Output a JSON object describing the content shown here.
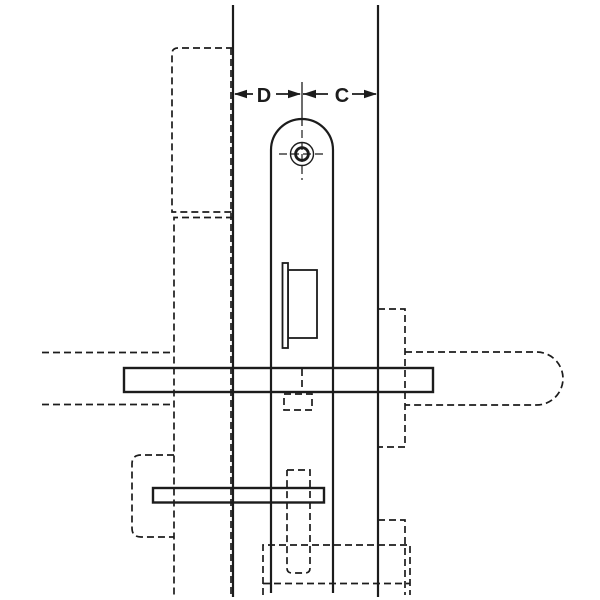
{
  "diagram": {
    "type": "technical-drawing",
    "background_color": "#ffffff",
    "line_color": "#1c1c1c",
    "dimension": {
      "label_d": "D",
      "label_c": "C"
    },
    "icons": {
      "screw_head": "screw-head-icon",
      "dimension_arrows": "dimension-arrow-icons"
    }
  }
}
